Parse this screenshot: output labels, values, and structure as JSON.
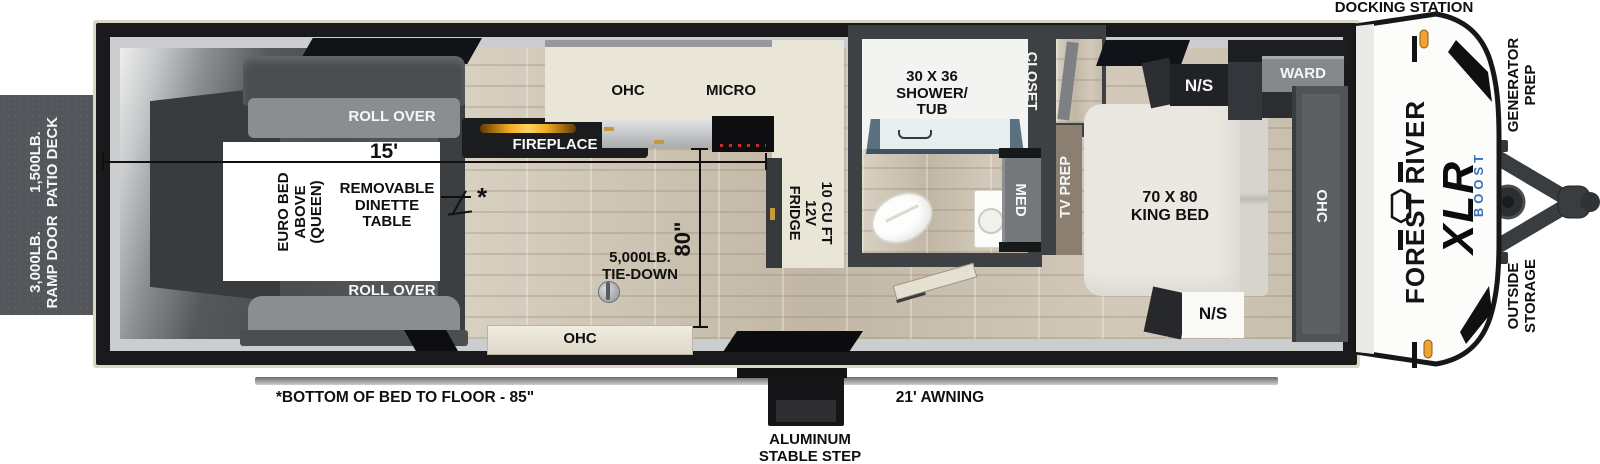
{
  "exterior": {
    "patio_deck": [
      "1,500LB.",
      "PATIO DECK"
    ],
    "ramp_door": [
      "3,000LB.",
      "RAMP DOOR"
    ],
    "docking_station": "DOCKING STATION",
    "generator_prep": [
      "GENERATOR",
      "PREP"
    ],
    "outside_storage": [
      "OUTSIDE",
      "STORAGE"
    ],
    "awning": "21' AWNING",
    "step": [
      "ALUMINUM",
      "STABLE STEP"
    ],
    "bed_height_note": "*BOTTOM OF BED TO FLOOR - 85\""
  },
  "branding": {
    "make": "FOREST RIVER",
    "model": "XLR",
    "trim": "BOOST"
  },
  "garage": {
    "roll_over_top": "ROLL OVER",
    "roll_over_bottom": "ROLL OVER",
    "garage_length": "15'",
    "garage_width": "80\"",
    "euro_bed": [
      "EURO BED",
      "ABOVE",
      "(QUEEN)"
    ],
    "dinette": [
      "REMOVABLE",
      "DINETTE",
      "TABLE"
    ],
    "dinette_note_symbol": "*",
    "tie_down": [
      "5,000LB.",
      "TIE-DOWN"
    ]
  },
  "kitchen": {
    "ohc": "OHC",
    "micro": "MICRO",
    "fireplace": "FIREPLACE",
    "fridge": [
      "10 CU FT",
      "12V",
      "FRIDGE"
    ],
    "hall_ohc": "OHC"
  },
  "bathroom": {
    "shower": [
      "30 X 36",
      "SHOWER/",
      "TUB"
    ],
    "med": "MED"
  },
  "bedroom": {
    "closet": "CLOSET",
    "tv_prep": "TV PREP",
    "king_bed": [
      "70 X 80",
      "KING BED"
    ],
    "ns_top": "N/S",
    "ns_bottom": "N/S",
    "ward": "WARD",
    "ohc": "OHC"
  },
  "colors": {
    "accent_amber": "#f0a91f",
    "boost_blue": "#3a70b8",
    "wall_dark": "#3e4144",
    "counter_cream": "#e9e5d7",
    "marker_orange": "#f2a235"
  }
}
